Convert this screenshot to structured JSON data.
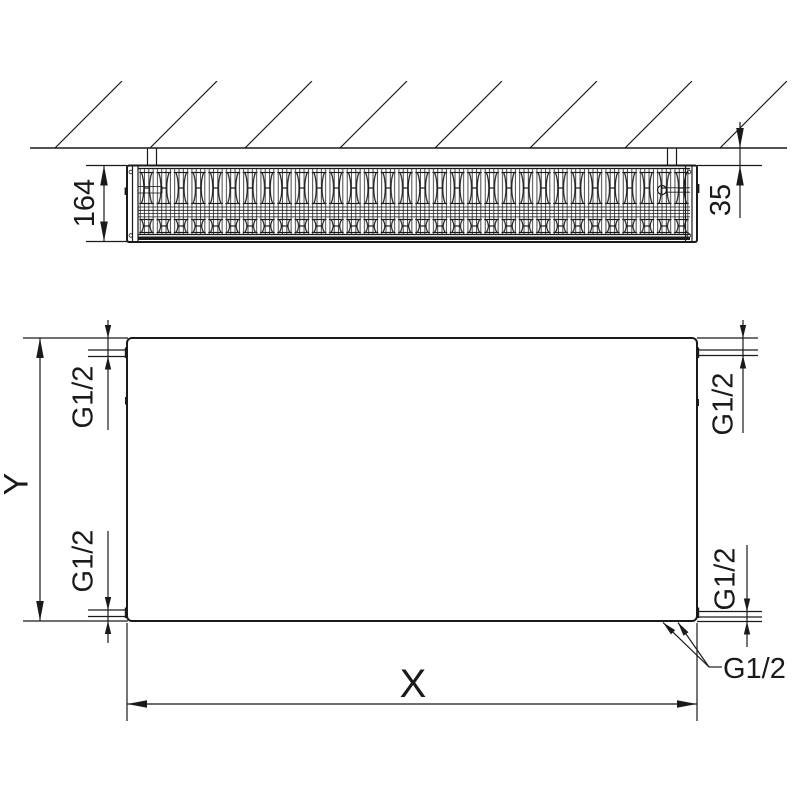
{
  "top_view": {
    "depth": "164",
    "wall_gap": "35"
  },
  "front_view": {
    "height": "Y",
    "width": "X",
    "threads": {
      "top_left": "G1/2",
      "bottom_left": "G1/2",
      "top_right": "G1/2",
      "bottom_right": "G1/2",
      "bottom_pair": "G1/2"
    }
  },
  "colors": {
    "line": "#1a1a1a",
    "background": "#ffffff"
  }
}
